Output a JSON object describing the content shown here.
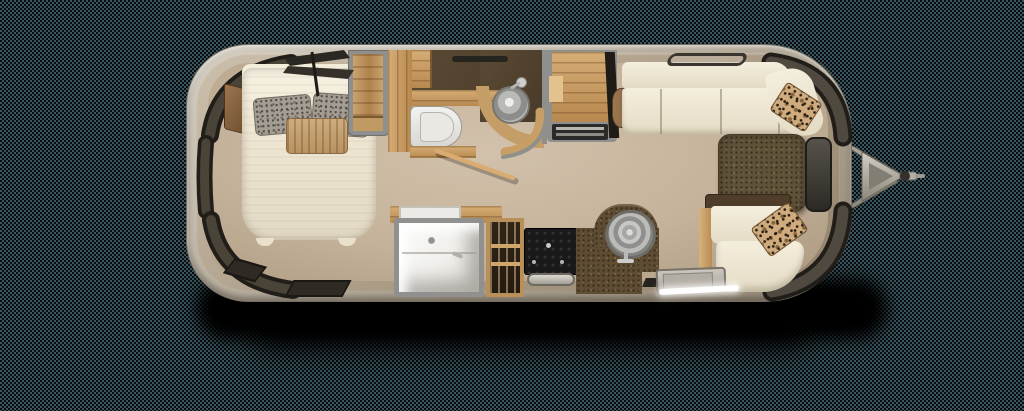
{
  "title": "Airstream travel trailer floor plan (top-down view)",
  "type": "floorplan",
  "palette": {
    "background_checker_dark": "#0b0e10",
    "background_checker_light": "#3a555e",
    "shell_metal": "#b2a897",
    "interior_wall": "#ab9c86",
    "floor_tan": "#c5b29a",
    "bathroom_floor_brown": "#53432f",
    "wood_oak": "#c49d67",
    "window_shade_dark": "#37332c",
    "cushion_cream": "#efe8d6",
    "counter_brown": "#5e4c33",
    "stove_black": "#1c1c1c",
    "stainless_steel": "#b5b5b3",
    "leopard_pillow": "#cfab7e",
    "drop_shadow": "#000000"
  },
  "areas": {
    "bedroom": {
      "label": "Bedroom",
      "items": [
        "queen bed",
        "speckled pillows",
        "accent pillow",
        "corner shelf",
        "closet",
        "roof fan",
        "floor vents",
        "wrap-around window shades"
      ]
    },
    "bathroom": {
      "label": "Bathroom",
      "items": [
        "toilet",
        "round sink with faucet",
        "vanity counter",
        "privacy door",
        "vent"
      ]
    },
    "kitchen": {
      "label": "Kitchen / Galley",
      "items": [
        "shower",
        "pantry cabinet",
        "stove with oven handle",
        "round kitchen sink",
        "curved counter",
        "refrigerator cabinet",
        "entry step with light strip",
        "floor mat"
      ]
    },
    "lounge": {
      "label": "Front lounge",
      "items": [
        "L-shaped sofa",
        "dinette table",
        "curved bench seat",
        "leopard print pillows",
        "side window",
        "roof vent"
      ]
    }
  },
  "hitch": {
    "label": "Tow hitch",
    "items": [
      "A-frame tongue",
      "coupler",
      "jack handle"
    ]
  }
}
